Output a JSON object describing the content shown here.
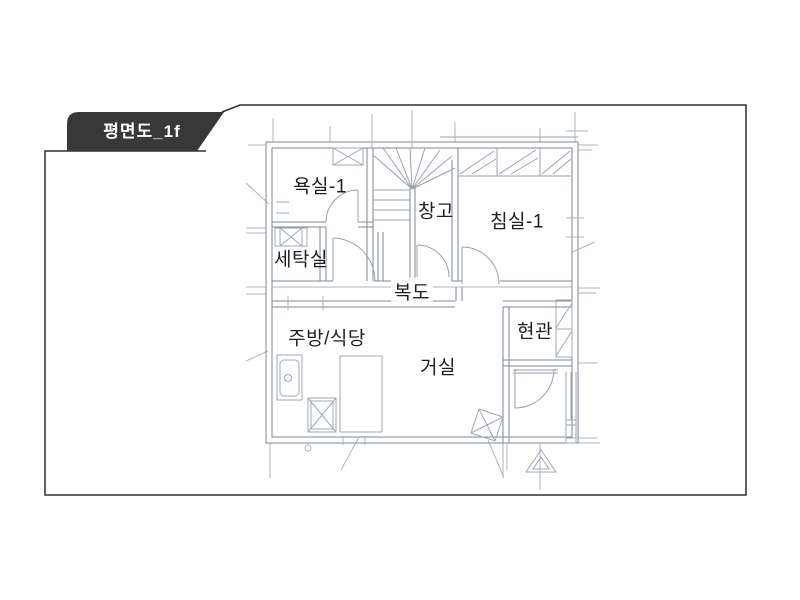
{
  "tab": {
    "label": "평면도_1f"
  },
  "floor_plan": {
    "rooms": [
      {
        "id": "bathroom-1",
        "label": "욕실-1"
      },
      {
        "id": "storage",
        "label": "창고"
      },
      {
        "id": "bedroom-1",
        "label": "침실-1"
      },
      {
        "id": "laundry",
        "label": "세탁실"
      },
      {
        "id": "corridor",
        "label": "복도"
      },
      {
        "id": "kitchen-dining",
        "label": "주방/식당"
      },
      {
        "id": "entrance",
        "label": "현관"
      },
      {
        "id": "living",
        "label": "거실"
      }
    ],
    "colors": {
      "background": "#ffffff",
      "tab_bg": "#383838",
      "tab_text": "#ffffff",
      "frame_border": "#2f2f2f",
      "wall_line": "#7e8795",
      "sketch_line": "#9aa2ae",
      "label_text": "#1f1f1f"
    }
  }
}
